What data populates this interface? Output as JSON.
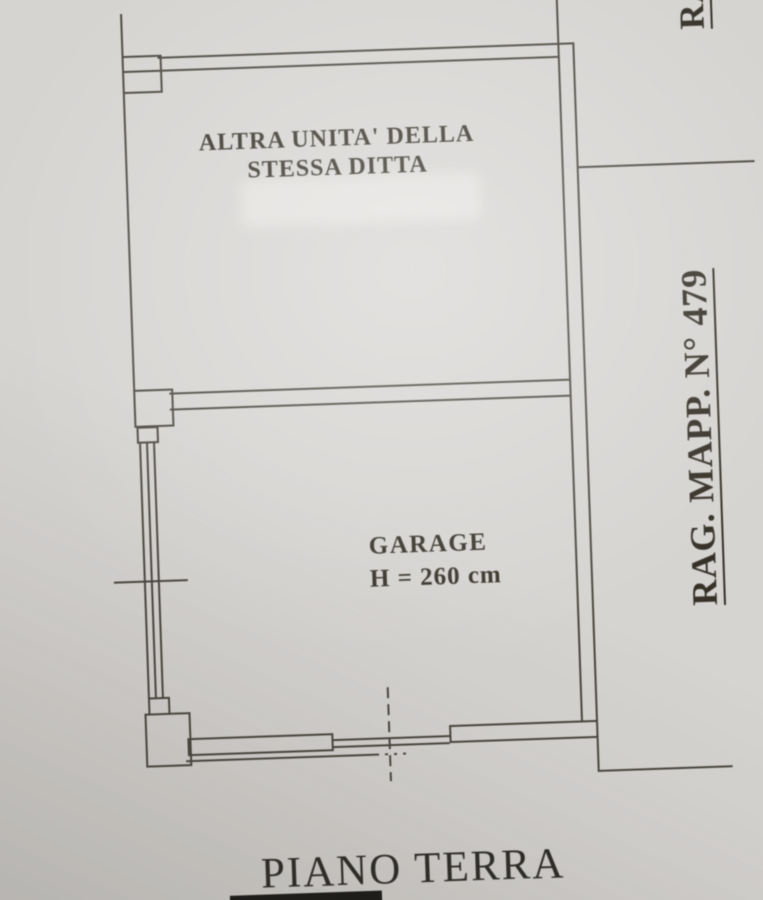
{
  "plan": {
    "upper_room": {
      "label_line1": "ALTRA UNITA' DELLA",
      "label_line2": "STESSA DITTA"
    },
    "garage": {
      "name": "GARAGE",
      "height_note": "H = 260 cm"
    },
    "side_label": "RAG. MAPP. N° 479",
    "side_label_partial": "RAG.",
    "title": "PIANO TERRA"
  },
  "colors": {
    "paper": "#d6d4d1",
    "ink": "#4a463f",
    "text": "#353128"
  }
}
